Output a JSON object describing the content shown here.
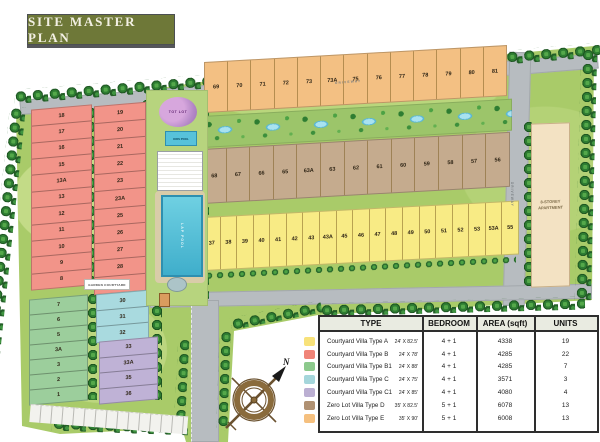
{
  "title": "SITE MASTER PLAN",
  "plan": {
    "labels": {
      "apartment": "8-STOREY APARTMENT",
      "driveway": "DRIVEWAY",
      "tot_lot": "TOT LOT",
      "kids_pool": "KIDS POOL",
      "lap_pool": "LAP POOL",
      "garden_courtyard": "GARDEN COURTYARD",
      "compass_north": "N"
    },
    "colors": {
      "type_a": "#F8EB85",
      "type_b": "#F29489",
      "type_b1": "#9CCE9C",
      "type_c": "#A9DADF",
      "type_c1": "#BFB2D6",
      "type_d": "#C5AB8E",
      "type_e": "#F3C083"
    },
    "plots": {
      "type_e_row": [
        "69",
        "70",
        "71",
        "72",
        "73",
        "73A",
        "75",
        "76",
        "77",
        "78",
        "79",
        "80",
        "81"
      ],
      "type_d_row": [
        "68",
        "67",
        "66",
        "65",
        "63A",
        "63",
        "62",
        "61",
        "60",
        "59",
        "58",
        "57",
        "56"
      ],
      "type_a_row": [
        "37",
        "38",
        "39",
        "40",
        "41",
        "42",
        "43",
        "43A",
        "45",
        "46",
        "47",
        "48",
        "49",
        "50",
        "51",
        "52",
        "53",
        "53A",
        "55"
      ],
      "type_b_col_left": [
        "18",
        "17",
        "16",
        "15",
        "13A",
        "13",
        "12",
        "11",
        "10",
        "9",
        "8"
      ],
      "type_b_col_right": [
        "19",
        "20",
        "21",
        "22",
        "23",
        "23A",
        "25",
        "26",
        "27",
        "28",
        "29"
      ],
      "type_b1_col": [
        "7",
        "6",
        "5",
        "3A",
        "3",
        "2",
        "1"
      ],
      "type_c_col": [
        "30",
        "31",
        "32"
      ],
      "type_c1_col": [
        "33",
        "33A",
        "35",
        "36"
      ]
    }
  },
  "legend_table": {
    "headers": [
      "TYPE",
      "BEDROOM",
      "AREA (sqft)",
      "UNITS"
    ],
    "rows": [
      {
        "color": "#F8E27A",
        "name": "Courtyard Villa Type A",
        "size": "24' X 82.5'",
        "bedroom": "4 + 1",
        "area": "4338",
        "units": "19"
      },
      {
        "color": "#F08478",
        "name": "Courtyard Villa Type B",
        "size": "24' X 78'",
        "bedroom": "4 + 1",
        "area": "4285",
        "units": "22"
      },
      {
        "color": "#8CC98C",
        "name": "Courtyard Villa Type B1",
        "size": "24' X 88'",
        "bedroom": "4 + 1",
        "area": "4285",
        "units": "7"
      },
      {
        "color": "#A5D6DB",
        "name": "Courtyard Villa Type C",
        "size": "24' X 75'",
        "bedroom": "4 + 1",
        "area": "3571",
        "units": "3"
      },
      {
        "color": "#BBAFD2",
        "name": "Courtyard Villa Type C1",
        "size": "24' X 85'",
        "bedroom": "4 + 1",
        "area": "4080",
        "units": "4"
      },
      {
        "color": "#B09172",
        "name": "Zero Lot Villa Type D",
        "size": "35' X 82.5'",
        "bedroom": "5 + 1",
        "area": "6078",
        "units": "13"
      },
      {
        "color": "#F5C07F",
        "name": "Zero Lot Villa Type E",
        "size": "35' X 90'",
        "bedroom": "5 + 1",
        "area": "6008",
        "units": "13"
      }
    ]
  }
}
